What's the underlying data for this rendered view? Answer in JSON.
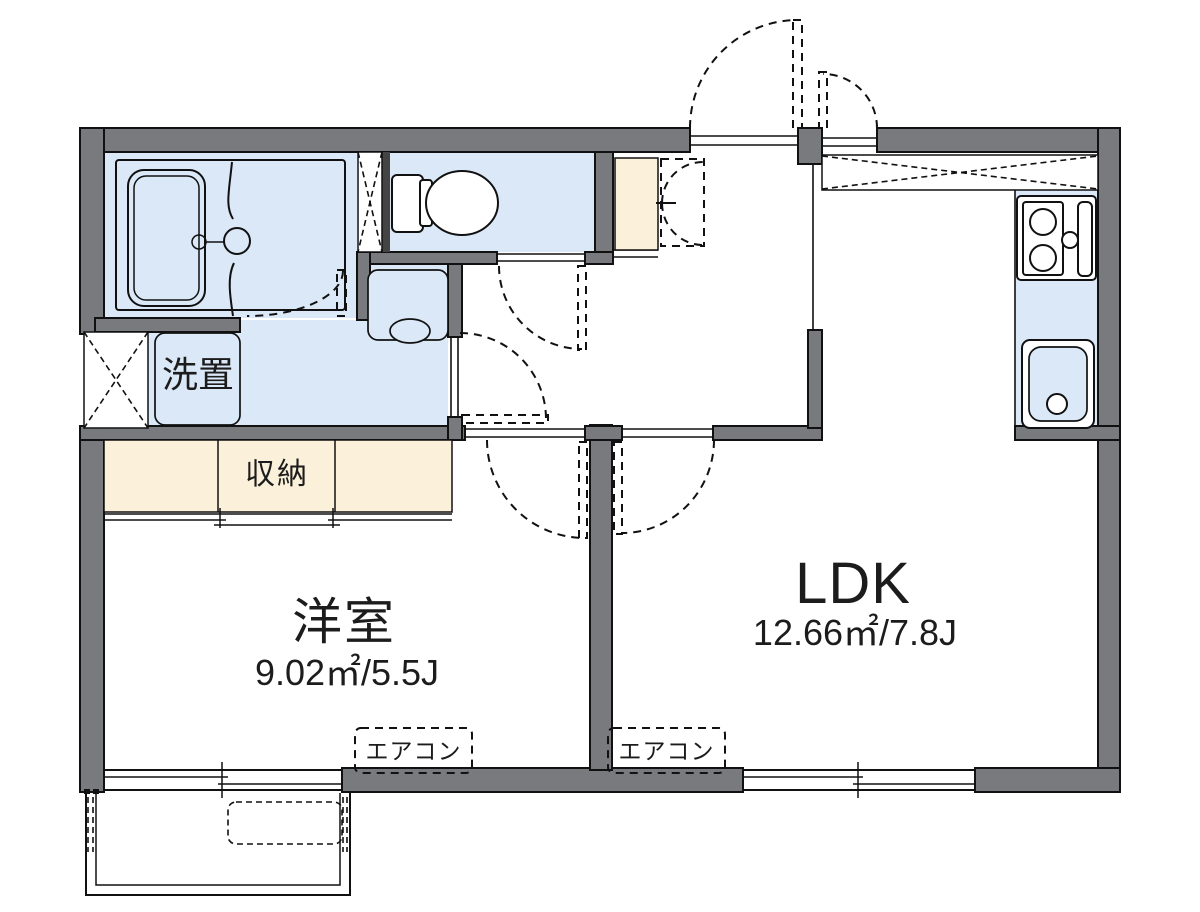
{
  "plan_type": "apartment-floor-plan",
  "rooms": {
    "western": {
      "name": "洋室",
      "size": "9.02㎡/5.5J"
    },
    "ldk": {
      "name": "LDK",
      "size": "12.66㎡/7.8J"
    }
  },
  "labels": {
    "closet": "収納",
    "laundry": "洗置",
    "aircon": "エアコン"
  },
  "fixtures": [
    "bathtub",
    "unit-bath",
    "toilet",
    "washbasin",
    "washing-machine-pan",
    "stove-2-burner",
    "kitchen-sink",
    "shoe-cabinet",
    "overhead-cupboard",
    "pipe-space",
    "balcony",
    "ac-outdoor-unit",
    "sliding-window",
    "entrance-door"
  ],
  "colors": {
    "wall": "#797a7e",
    "water": "#dbe8f7",
    "storage": "#fbf0d9",
    "text": "#1c1c1c"
  }
}
